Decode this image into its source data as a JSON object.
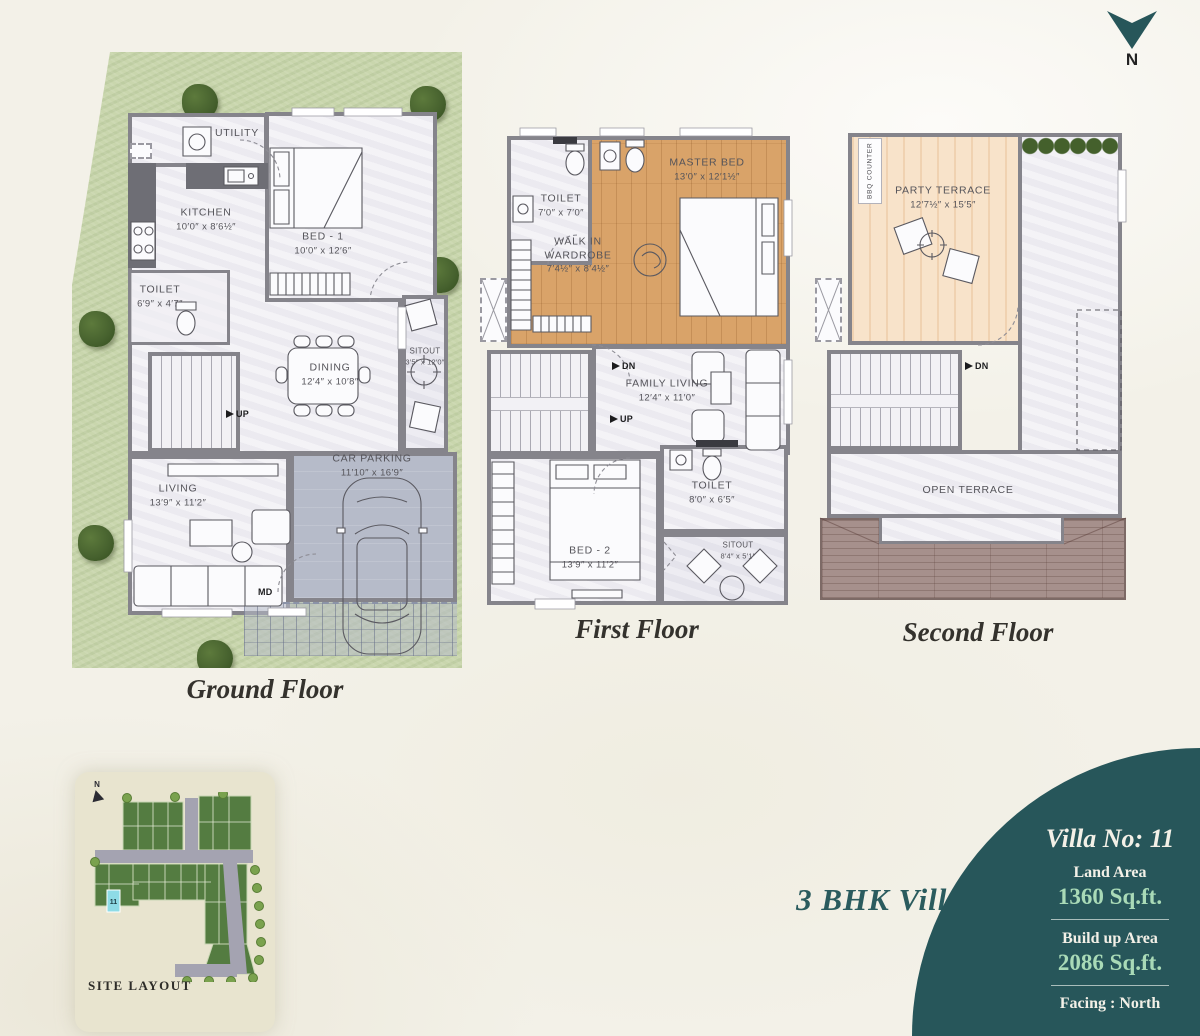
{
  "colors": {
    "bg": "#f3f1e8",
    "teal": "#27565a",
    "mint": "#a9dab7",
    "ink": "#34322d",
    "label": "#55545a",
    "wall": "#85848b",
    "floor": "#efeef3",
    "floor-dim": "#e7e6ee",
    "wood": "#d9a369",
    "peach": "#f8e3ca",
    "grass": "#c9d6ad",
    "tree": "#4a612f",
    "parking": "#b6bbc9",
    "roof": "#a6908c",
    "card": "#e8e4cf",
    "map-green": "#547c41",
    "map-road": "#a4a3b1",
    "map-cyan": "#8edbe6",
    "hedge": "#44602c"
  },
  "north": {
    "label": "N"
  },
  "floors": {
    "ground": {
      "caption": "Ground Floor",
      "up": "UP",
      "md": "MD",
      "rooms": {
        "utility": {
          "name": "UTILITY"
        },
        "kitchen": {
          "name": "KITCHEN",
          "dims": "10′0″ x 8′6½″"
        },
        "bed1": {
          "name": "BED - 1",
          "dims": "10′0″ x 12′6″"
        },
        "toilet": {
          "name": "TOILET",
          "dims": "6′9″ x 4′7″"
        },
        "dining": {
          "name": "DINING",
          "dims": "12′4″ x 10′8″"
        },
        "sitout": {
          "name": "SITOUT",
          "dims": "3′5″ x 12′0″"
        },
        "living": {
          "name": "LIVING",
          "dims": "13′9″ x 11′2″"
        },
        "parking": {
          "name": "CAR PARKING",
          "dims": "11′10″ x 16′9″"
        }
      }
    },
    "first": {
      "caption": "First Floor",
      "dn": "DN",
      "up": "UP",
      "rooms": {
        "toilet1": {
          "name": "TOILET",
          "dims": "7′0″ x 7′0″"
        },
        "wardrobe": {
          "line1": "WALK IN",
          "line2": "WARDROBE",
          "dims": "7′4½″ x 8′4½″"
        },
        "master": {
          "name": "MASTER BED",
          "dims": "13′0″ x 12′1½″"
        },
        "family": {
          "name": "FAMILY LIVING",
          "dims": "12′4″ x 11′0″"
        },
        "bed2": {
          "name": "BED - 2",
          "dims": "13′9″ x 11′2″"
        },
        "toilet2": {
          "name": "TOILET",
          "dims": "8′0″ x 6′5″"
        },
        "sitout": {
          "name": "SITOUT",
          "dims": "8′4″ x 5′1″"
        }
      }
    },
    "second": {
      "caption": "Second Floor",
      "dn": "DN",
      "rooms": {
        "bbq": {
          "name": "BBQ COUNTER"
        },
        "party": {
          "name": "PARTY TERRACE",
          "dims": "12′7½″ x 15′5″"
        },
        "open": {
          "name": "OPEN TERRACE"
        }
      }
    }
  },
  "site_layout": {
    "title": "SITE LAYOUT",
    "north": "N",
    "plot": "11"
  },
  "villa": {
    "type": "3 BHK Villa",
    "number": "Villa No: 11",
    "land_label": "Land Area",
    "land_value": "1360 Sq.ft.",
    "build_label": "Build up Area",
    "build_value": "2086 Sq.ft.",
    "facing": "Facing : North"
  }
}
